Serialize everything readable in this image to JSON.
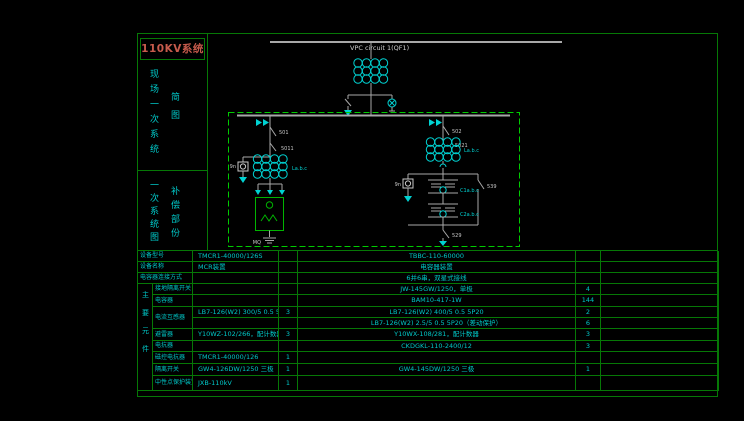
{
  "drawing": {
    "title": "110KV系统",
    "title_color": "#c75b4c",
    "sidebar": {
      "section1_main": "现场一次系统",
      "section1_sub": "简图",
      "section2_main": "一次系统图",
      "section2_sub": "补偿部份"
    }
  },
  "schematic": {
    "incoming_label": "VPC circuit 1(QF1)",
    "labels": {
      "left_breaker": "501",
      "left_disconnect": "5011",
      "left_transformer": "La.b.c",
      "left_pt": "9n",
      "left_reactor_ground": "MQ",
      "right_breaker": "502",
      "right_disconnect": "5021",
      "right_transformer": "La.b.c",
      "right_pt": "9n",
      "cap_switch": "539",
      "cap_group1": "C1a.b.c",
      "cap_group2": "C2a.b.c",
      "bottom_switch": "529"
    },
    "colors": {
      "wire": "#b0b0b0",
      "device": "#00d2d2",
      "reactor_green": "#00b400",
      "frame_green": "#067806",
      "dashed_green": "#00cc00"
    }
  },
  "table": {
    "group_label": "主要元件",
    "rows": [
      {
        "label": "设备型号",
        "v1": "TMCR1-40000/126S",
        "q1": "",
        "v2": "TBBC-110-60000",
        "q2": ""
      },
      {
        "label": "设备名称",
        "v1": "MCR装置",
        "q1": "",
        "v2": "电容器装置",
        "q2": ""
      },
      {
        "label": "电容器连接方式",
        "v1": "",
        "q1": "",
        "v2": "6并6串，双星式接线",
        "q2": ""
      },
      {
        "label": "接地隔离开关",
        "v1": "",
        "q1": "",
        "v2": "JW-145GW/1250，单极",
        "q2": "4"
      },
      {
        "label": "电容器",
        "v1": "",
        "q1": "",
        "v2": "BAM10-417-1W",
        "q2": "144"
      },
      {
        "label": "电流互感器",
        "v1": "LB7-126(W2) 300/5 0.5 5P20",
        "q1": "3",
        "v2": "LB7-126(W2) 400/5 0.5 5P20",
        "q2": "2"
      },
      {
        "label": "",
        "v1": "",
        "q1": "",
        "v2": "LB7-126(W2) 2.5/5 0.5 5P20（差动保护）",
        "q2": "6"
      },
      {
        "label": "避雷器",
        "v1": "Y10WZ-102/266，配计数器",
        "q1": "3",
        "v2": "Y10WX-108/281，配计数器",
        "q2": "3"
      },
      {
        "label": "电抗器",
        "v1": "",
        "q1": "",
        "v2": "CKDGKL-110-2400/12",
        "q2": "3"
      },
      {
        "label": "磁控电抗器",
        "v1": "TMCR1-40000/126",
        "q1": "1",
        "v2": "",
        "q2": ""
      },
      {
        "label": "隔离开关",
        "v1": "GW4-126DW/1250 三极",
        "q1": "1",
        "v2": "GW4-145DW/1250 三极",
        "q2": "1"
      },
      {
        "label": "中性点保护装置",
        "v1": "JXB-110kV",
        "q1": "1",
        "v2": "",
        "q2": ""
      }
    ]
  }
}
